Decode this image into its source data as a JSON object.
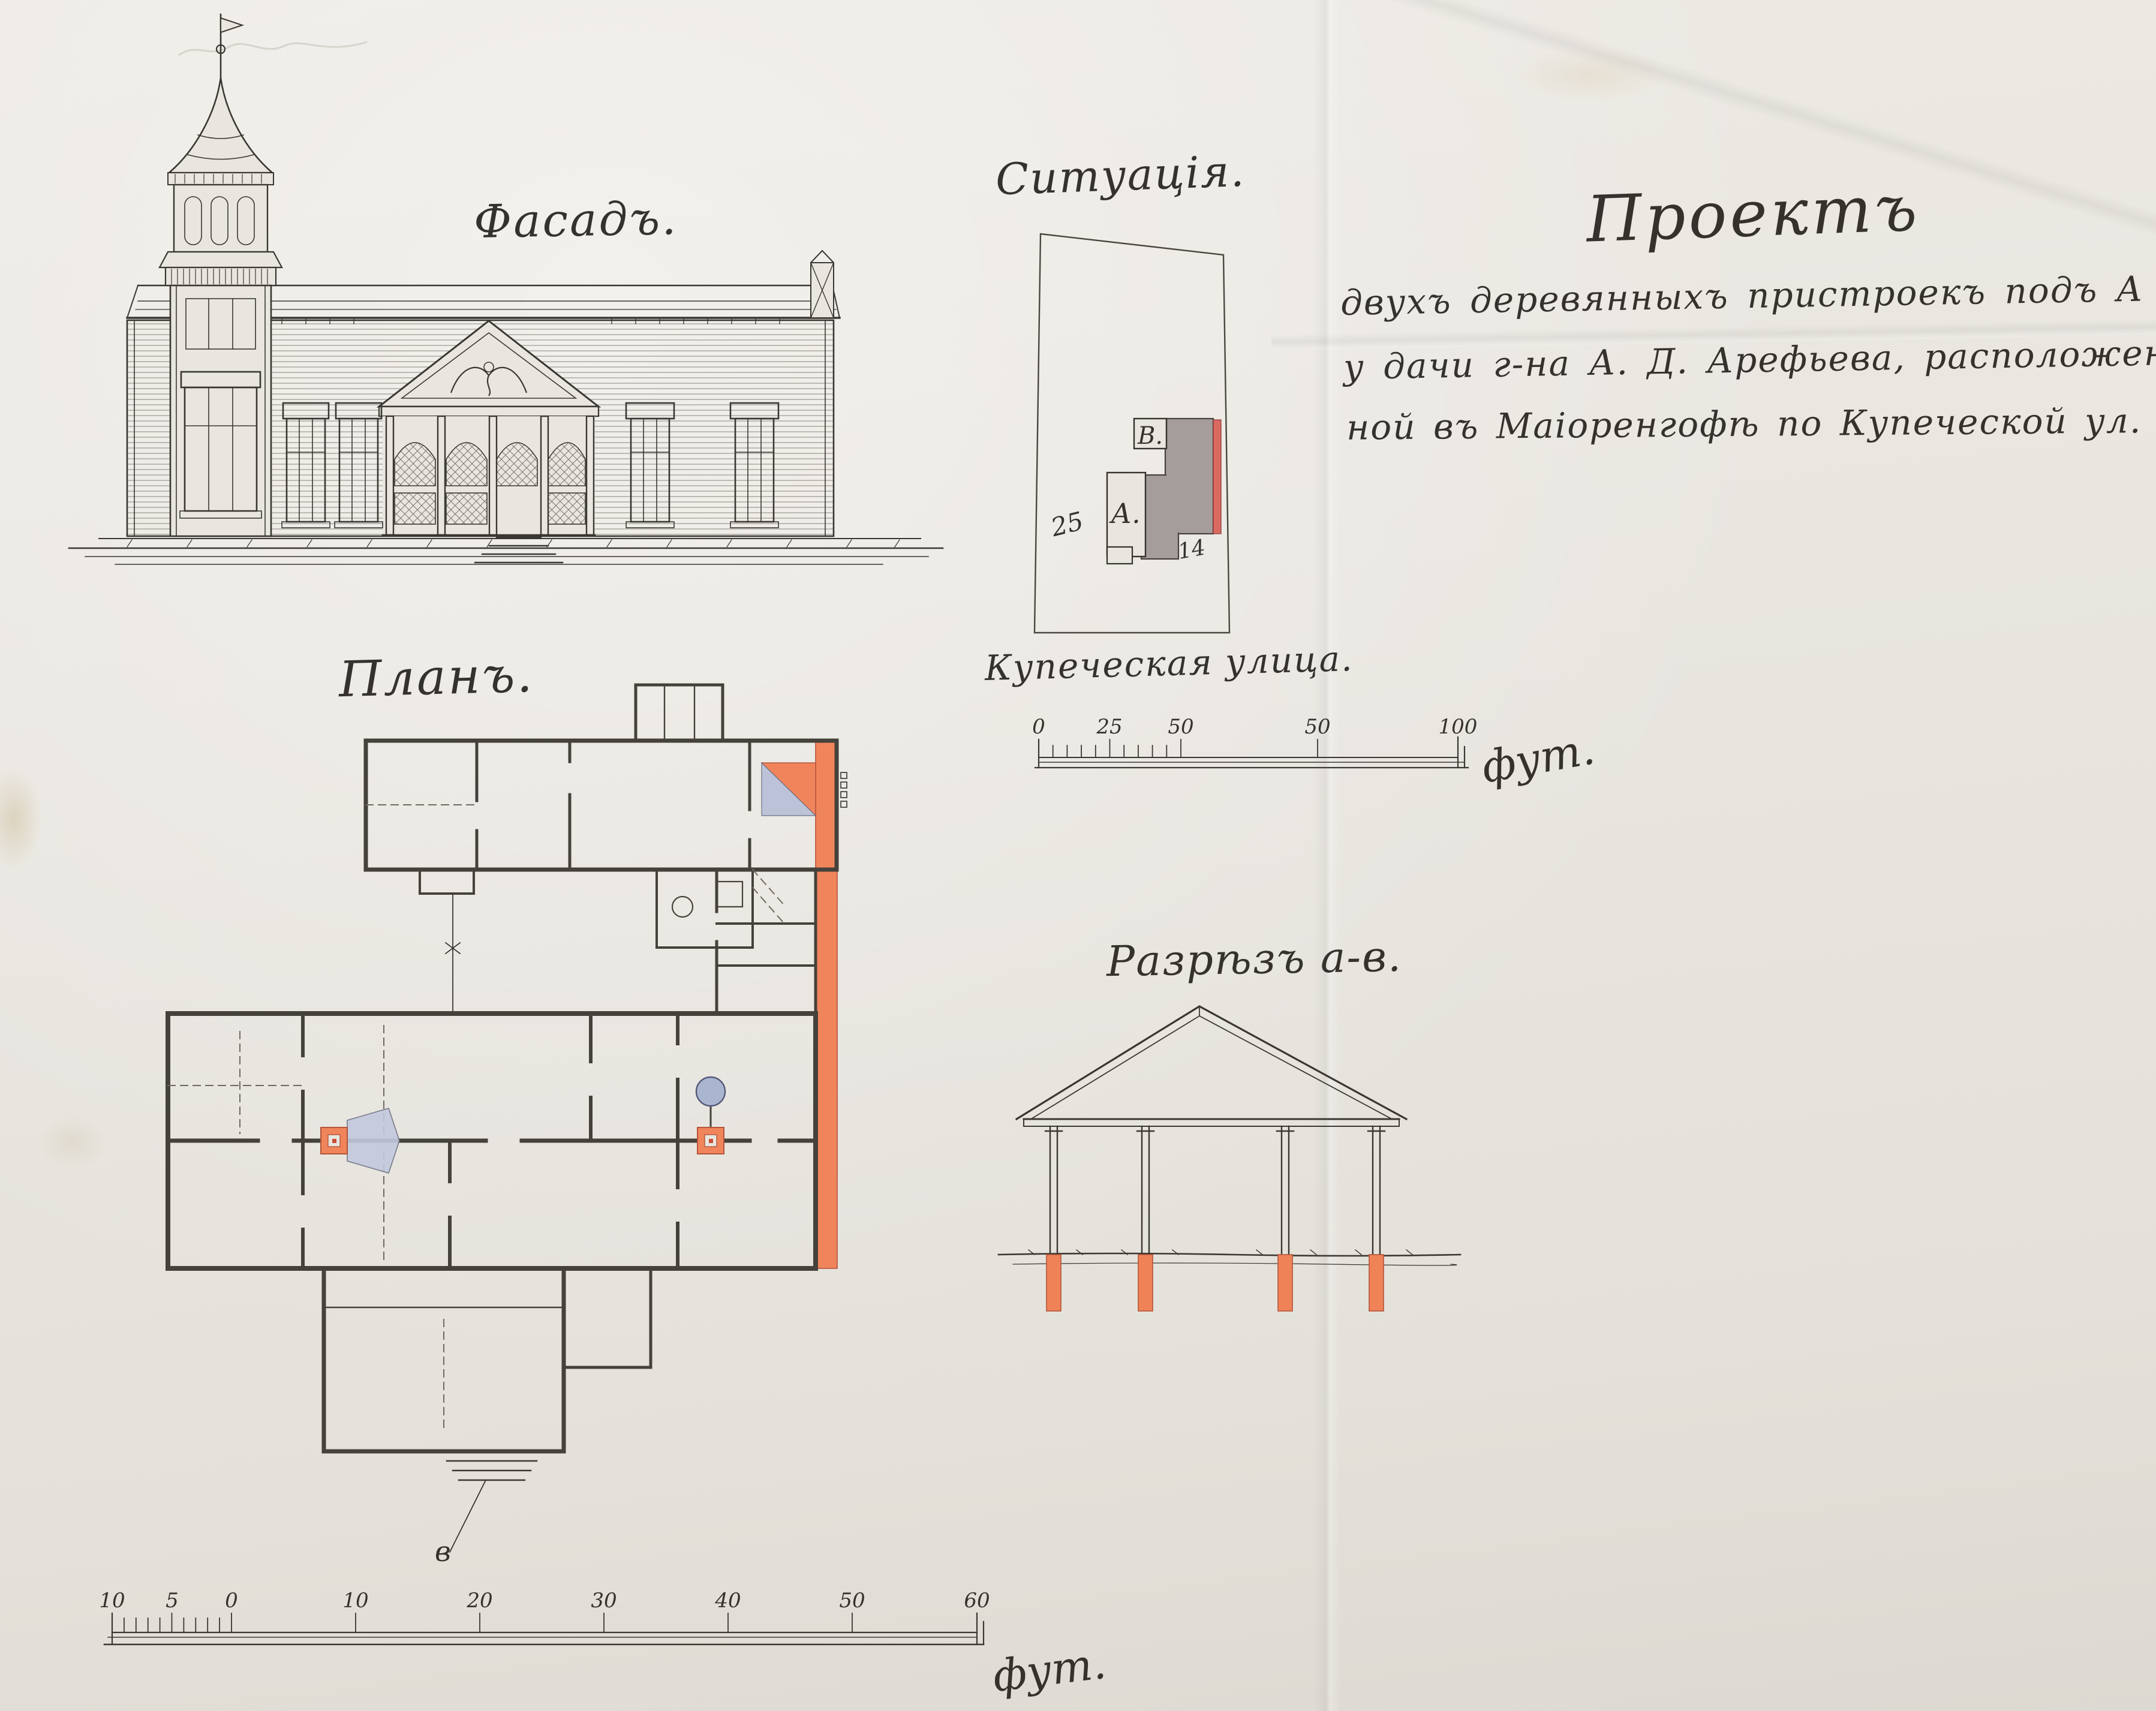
{
  "page": {
    "titles": {
      "facade": "Фасадъ.",
      "situation": "Ситуація.",
      "plan": "Планъ.",
      "section": "Разрѣзъ а-в."
    },
    "project": {
      "heading": "Проектъ",
      "lines": [
        "двухъ деревянныхъ пристроекъ подъ А и В",
        "у дачи г-на А. Д. Арефьева, расположен-",
        "ной въ Маіоренгофѣ по Купеческой ул. № 22."
      ]
    },
    "situation": {
      "building_a": "А.",
      "building_b": "В.",
      "dim_left": "25",
      "dim_right": "14",
      "street": "Купеческая улица."
    },
    "plan": {
      "entrance_marker": "в"
    },
    "scale_top": {
      "labels": [
        "0",
        "25",
        "50",
        "50",
        "100"
      ],
      "unit": "фут."
    },
    "scale_bottom": {
      "labels": [
        "10",
        "5",
        "0",
        "10",
        "20",
        "30",
        "40",
        "50",
        "60"
      ],
      "unit": "фут."
    },
    "colors": {
      "paper": "#e9e6e0",
      "ink": "#35322d",
      "new_work_orange": "#f0855c",
      "new_work_red": "#d96a62",
      "wash_blue": "#aab6d0",
      "existing_gray": "#a59d9c"
    }
  }
}
